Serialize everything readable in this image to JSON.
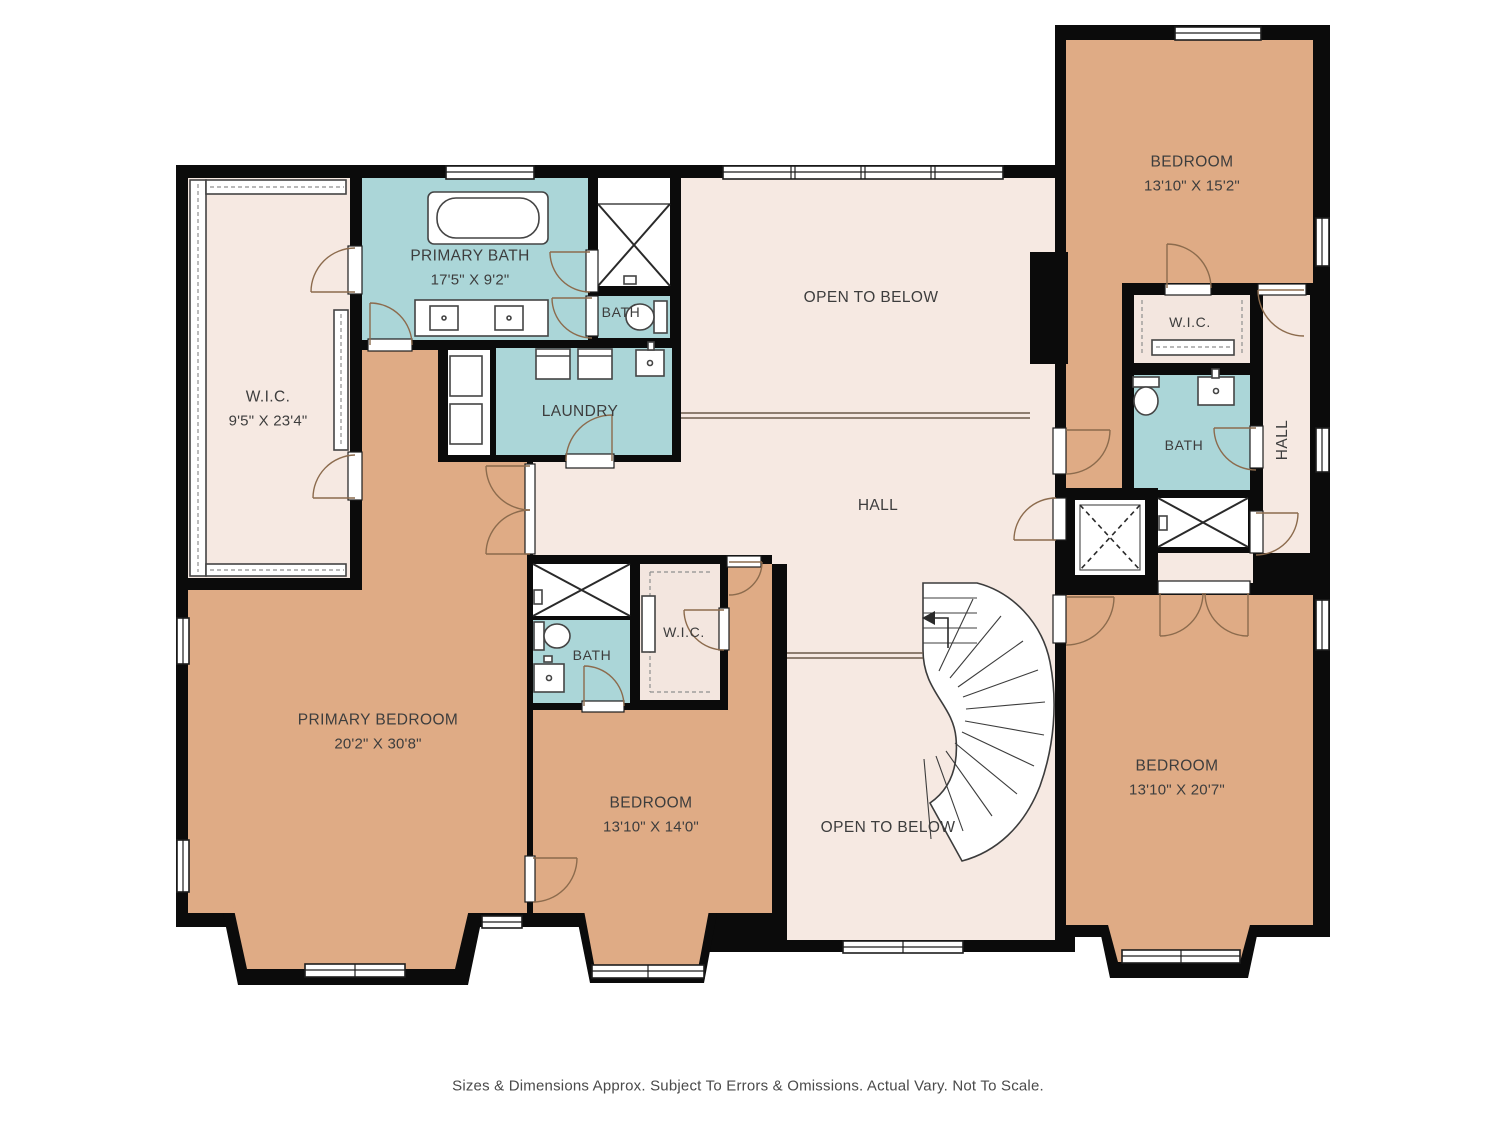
{
  "colors": {
    "wall": "#0b0b0b",
    "bedroom": "#dfab85",
    "bath": "#abd6d8",
    "hall": "#f6e9e2",
    "wicpale": "#f3e6df",
    "door": "#8c6b4d",
    "text": "#3d3d3d"
  },
  "rooms": {
    "primary_bath": {
      "name": "PRIMARY BATH",
      "dims": "17'5\" X 9'2\""
    },
    "wc_top": {
      "name": "BATH"
    },
    "wic_left": {
      "name": "W.I.C.",
      "dims": "9'5\" X 23'4\""
    },
    "laundry": {
      "name": "LAUNDRY"
    },
    "open_below_top": {
      "name": "OPEN TO BELOW"
    },
    "hall_center": {
      "name": "HALL"
    },
    "bedroom_top_right": {
      "name": "BEDROOM",
      "dims": "13'10\" X 15'2\""
    },
    "wic_right": {
      "name": "W.I.C."
    },
    "bath_right": {
      "name": "BATH"
    },
    "hall_right": {
      "name": "HALL"
    },
    "primary_bedroom": {
      "name": "PRIMARY BEDROOM",
      "dims": "20'2\" X 30'8\""
    },
    "bath_center": {
      "name": "BATH"
    },
    "wic_center": {
      "name": "W.I.C."
    },
    "bedroom_center": {
      "name": "BEDROOM",
      "dims": "13'10\" X 14'0\""
    },
    "open_below_bottom": {
      "name": "OPEN TO BELOW"
    },
    "bedroom_bottom_right": {
      "name": "BEDROOM",
      "dims": "13'10\" X 20'7\""
    }
  },
  "footer": {
    "disclaimer": "Sizes & Dimensions Approx. Subject To Errors & Omissions. Actual Vary. Not To Scale."
  }
}
